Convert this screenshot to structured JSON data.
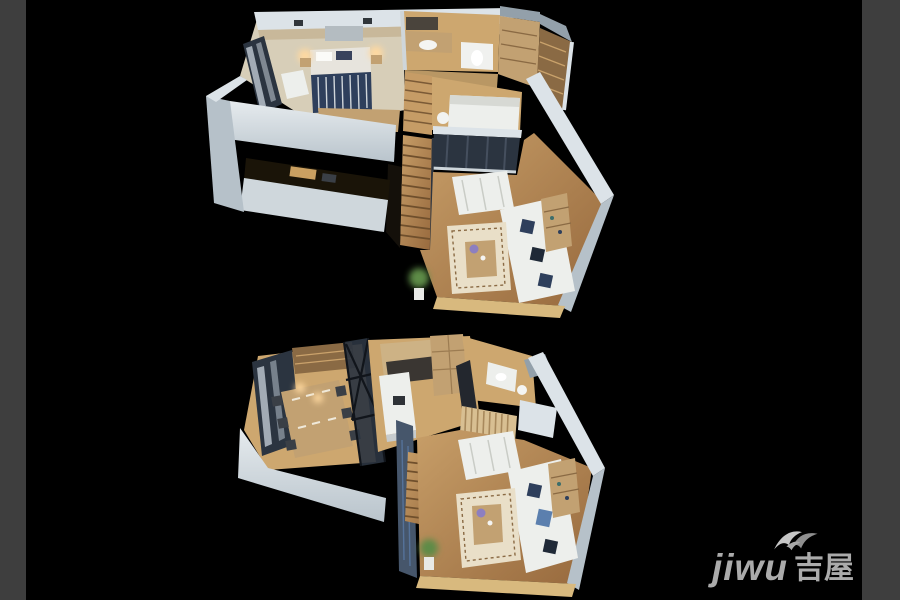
{
  "page": {
    "background_color": "#000000",
    "side_frame_color": "#3e3e3e"
  },
  "watermark": {
    "latin": "jiwu",
    "cjk": "吉屋",
    "icon": "bird-ribbon-icon",
    "color": "#ababab"
  },
  "scene": {
    "kind": "isometric-3d-floorplan-render",
    "levels": [
      {
        "id": "upper-level",
        "label": "Upper level of duplex apartment: master bedroom, bathroom, closet hall, second bedroom with glazed balcony, living room and staircase",
        "rooms": [
          "master-bedroom",
          "bathroom",
          "closet-hall",
          "wardrobe-shelves",
          "second-bedroom",
          "glazed-balcony",
          "living-room",
          "staircase",
          "void-over-study"
        ]
      },
      {
        "id": "lower-level",
        "label": "Lower level of duplex apartment: dining room, kitchen, entry bathroom, living room and staircase",
        "rooms": [
          "dining-room",
          "glass-partition",
          "kitchen",
          "entry-bathroom",
          "slat-screen",
          "living-room",
          "staircase"
        ]
      }
    ],
    "palette": {
      "wall": "#dce3e8",
      "wall_shade": "#b6c1c9",
      "wood_floor": "#b5885a",
      "wood_light": "#cda76f",
      "cabinet_wood": "#c2a172",
      "sofa_white": "#edefec",
      "bedding_navy": "#2e3f5c",
      "glass_frame": "#2b3440",
      "rug_cream": "#e9dfc8",
      "lamp_glow": "#ffd9a0",
      "plant_green": "#5d8b46"
    }
  }
}
